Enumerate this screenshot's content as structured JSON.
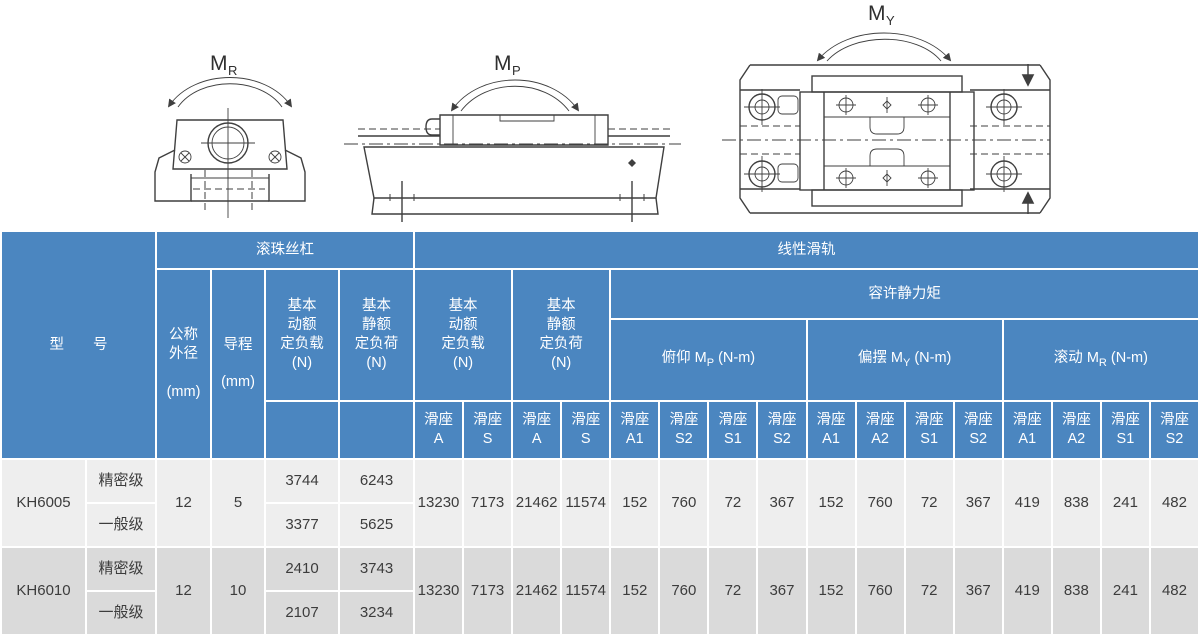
{
  "colors": {
    "header_blue": "#4b86c0",
    "row_light": "#eeeeee",
    "row_dark": "#dadada",
    "grid_line": "#ffffff",
    "text_dark": "#3c3c3c",
    "diagram_line": "#3f3f3f"
  },
  "diagrams": {
    "mr_label": {
      "prefix": "M",
      "sub": "R"
    },
    "mp_label": {
      "prefix": "M",
      "sub": "P"
    },
    "my_label": {
      "prefix": "M",
      "sub": "Y"
    }
  },
  "table": {
    "header": {
      "model": "型　　号",
      "ball_screw": "滚珠丝杠",
      "linear_rail": "线性滑轨",
      "nominal_od": "公称\n外径\n\n(mm)",
      "lead": "导程\n\n(mm)",
      "bs_dynamic": "基本\n动额\n定负载\n(N)",
      "bs_static": "基本\n静额\n定负荷\n(N)",
      "lr_dynamic": "基本\n动额\n定负载\n(N)",
      "lr_static": "基本\n静额\n定负荷\n(N)",
      "static_moment": "容许静力矩",
      "pitch": {
        "prefix": "俯仰 M",
        "sub": "P",
        "suffix": " (N-m)"
      },
      "yaw": {
        "prefix": "偏摆 M",
        "sub": "Y",
        "suffix": " (N-m)"
      },
      "roll": {
        "prefix": "滚动 M",
        "sub": "R",
        "suffix": " (N-m)"
      },
      "seats": [
        "滑座\nA",
        "滑座\nS",
        "滑座\nA",
        "滑座\nS",
        "滑座\nA1",
        "滑座\nS2",
        "滑座\nS1",
        "滑座\nS2",
        "滑座\nA1",
        "滑座\nA2",
        "滑座\nS1",
        "滑座\nS2",
        "滑座\nA1",
        "滑座\nA2",
        "滑座\nS1",
        "滑座\nS2"
      ]
    },
    "rows": [
      {
        "model": "KH6005",
        "grade_precision": "精密级",
        "grade_general": "一般级",
        "od": "12",
        "lead": "5",
        "dyn_precision": "3744",
        "stat_precision": "6243",
        "dyn_general": "3377",
        "stat_general": "5625",
        "shared": [
          "13230",
          "7173",
          "21462",
          "11574",
          "152",
          "760",
          "72",
          "367",
          "152",
          "760",
          "72",
          "367",
          "419",
          "838",
          "241",
          "482"
        ]
      },
      {
        "model": "KH6010",
        "grade_precision": "精密级",
        "grade_general": "一般级",
        "od": "12",
        "lead": "10",
        "dyn_precision": "2410",
        "stat_precision": "3743",
        "dyn_general": "2107",
        "stat_general": "3234",
        "shared": [
          "13230",
          "7173",
          "21462",
          "11574",
          "152",
          "760",
          "72",
          "367",
          "152",
          "760",
          "72",
          "367",
          "419",
          "838",
          "241",
          "482"
        ]
      }
    ]
  }
}
